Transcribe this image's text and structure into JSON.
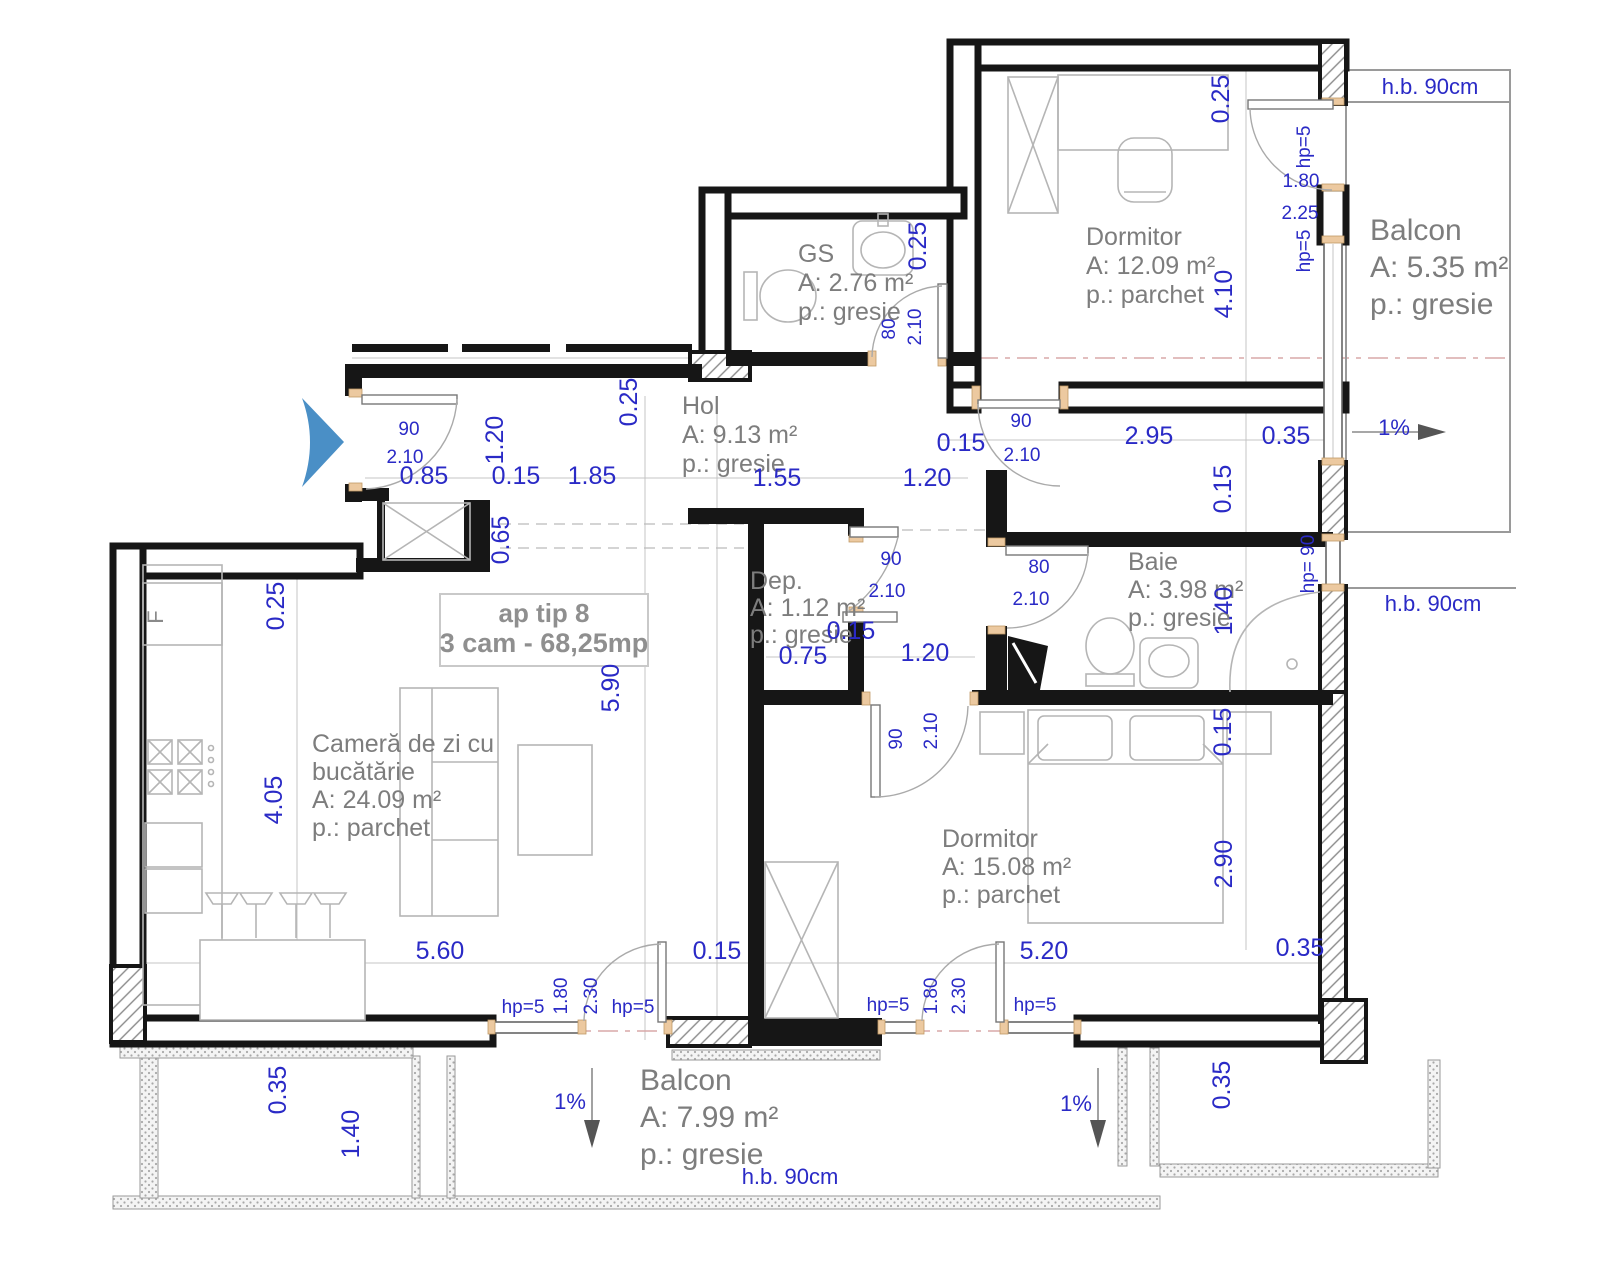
{
  "title": {
    "line1": "ap tip 8",
    "line2": "3 cam - 68,25mp"
  },
  "rooms": [
    {
      "id": "gs",
      "name": "GS",
      "area": "A: 2.76 m²",
      "floor": "p.: gresie",
      "x": 798,
      "y": 262,
      "lh": 29,
      "size": 25
    },
    {
      "id": "dormitor-1",
      "name": "Dormitor",
      "area": "A: 12.09 m²",
      "floor": "p.: parchet",
      "x": 1086,
      "y": 245,
      "lh": 29,
      "size": 25
    },
    {
      "id": "balcon-1",
      "name": "Balcon",
      "area": "A: 5.35 m²",
      "floor": "p.: gresie",
      "x": 1370,
      "y": 240,
      "lh": 37,
      "size": 30
    },
    {
      "id": "hol",
      "name": "Hol",
      "area": "A: 9.13 m²",
      "floor": "p.: gresie",
      "x": 682,
      "y": 414,
      "lh": 29,
      "size": 25
    },
    {
      "id": "dep",
      "name": "Dep.",
      "area": "A: 1.12 m²",
      "floor": "p.: gresie",
      "x": 750,
      "y": 589,
      "lh": 27,
      "size": 23
    },
    {
      "id": "baie",
      "name": "Baie",
      "area": "A: 3.98 m²",
      "floor": "p.: gresie",
      "x": 1128,
      "y": 570,
      "lh": 28,
      "size": 25
    },
    {
      "id": "camera-de-zi",
      "name": "Cameră de zi cu bucătărie",
      "area": "A: 24.09 m²",
      "floor": "p.: parchet",
      "lines": [
        "Cameră de zi cu",
        "bucătărie",
        "A: 24.09 m²",
        "p.: parchet"
      ],
      "x": 312,
      "y": 752,
      "lh": 28,
      "size": 25
    },
    {
      "id": "dormitor-2",
      "name": "Dormitor",
      "area": "A: 15.08 m²",
      "floor": "p.: parchet",
      "x": 942,
      "y": 847,
      "lh": 28,
      "size": 25
    },
    {
      "id": "balcon-2",
      "name": "Balcon",
      "area": "A: 7.99 m²",
      "floor": "p.: gresie",
      "x": 640,
      "y": 1090,
      "lh": 37,
      "size": 30
    }
  ],
  "dimensions": [
    {
      "t": "0.85",
      "x": 424,
      "y": 484
    },
    {
      "t": "0.15",
      "x": 516,
      "y": 484
    },
    {
      "t": "1.85",
      "x": 592,
      "y": 484
    },
    {
      "t": "1.55",
      "x": 777,
      "y": 486
    },
    {
      "t": "1.20",
      "x": 927,
      "y": 486
    },
    {
      "t": "1.20",
      "x": 503,
      "y": 440,
      "r": -90
    },
    {
      "t": "0.25",
      "x": 637,
      "y": 402,
      "r": -90
    },
    {
      "t": "0.65",
      "x": 509,
      "y": 540,
      "r": -90
    },
    {
      "t": "0.25",
      "x": 284,
      "y": 606,
      "r": -90
    },
    {
      "t": "4.05",
      "x": 282,
      "y": 800,
      "r": -90
    },
    {
      "t": "5.90",
      "x": 619,
      "y": 688,
      "r": -90
    },
    {
      "t": "0.25",
      "x": 926,
      "y": 246,
      "r": -90
    },
    {
      "t": "0.25",
      "x": 1229,
      "y": 99,
      "r": -90
    },
    {
      "t": "4.10",
      "x": 1232,
      "y": 294,
      "r": -90
    },
    {
      "t": "0.15",
      "x": 961,
      "y": 451
    },
    {
      "t": "2.95",
      "x": 1149,
      "y": 444
    },
    {
      "t": "0.35",
      "x": 1286,
      "y": 444
    },
    {
      "t": "0.15",
      "x": 1231,
      "y": 489,
      "r": -90
    },
    {
      "t": "1.40",
      "x": 1232,
      "y": 611,
      "r": -90
    },
    {
      "t": "0.15",
      "x": 1231,
      "y": 732,
      "r": -90
    },
    {
      "t": "2.90",
      "x": 1232,
      "y": 864,
      "r": -90
    },
    {
      "t": "0.15",
      "x": 851,
      "y": 639
    },
    {
      "t": "0.75",
      "x": 803,
      "y": 664
    },
    {
      "t": "1.20",
      "x": 925,
      "y": 661
    },
    {
      "t": "5.60",
      "x": 440,
      "y": 959
    },
    {
      "t": "0.15",
      "x": 717,
      "y": 959
    },
    {
      "t": "5.20",
      "x": 1044,
      "y": 959
    },
    {
      "t": "0.35",
      "x": 1300,
      "y": 956
    },
    {
      "t": "0.35",
      "x": 286,
      "y": 1090,
      "r": -90
    },
    {
      "t": "1.40",
      "x": 359,
      "y": 1134,
      "r": -90
    },
    {
      "t": "0.35",
      "x": 1230,
      "y": 1085,
      "r": -90
    }
  ],
  "door_labels": [
    {
      "t": "90",
      "x": 409,
      "y": 435
    },
    {
      "t": "2.10",
      "x": 405,
      "y": 463
    },
    {
      "t": "80",
      "x": 895,
      "y": 329,
      "r": -90
    },
    {
      "t": "2.10",
      "x": 921,
      "y": 327,
      "r": -90
    },
    {
      "t": "90",
      "x": 1021,
      "y": 427
    },
    {
      "t": "2.10",
      "x": 1022,
      "y": 461
    },
    {
      "t": "90",
      "x": 891,
      "y": 565
    },
    {
      "t": "2.10",
      "x": 887,
      "y": 597
    },
    {
      "t": "80",
      "x": 1039,
      "y": 573
    },
    {
      "t": "2.10",
      "x": 1031,
      "y": 605
    },
    {
      "t": "90",
      "x": 902,
      "y": 739,
      "r": -90
    },
    {
      "t": "2.10",
      "x": 937,
      "y": 731,
      "r": -90
    }
  ],
  "window_labels": [
    {
      "t": "hp=5",
      "x": 1310,
      "y": 147,
      "r": -90
    },
    {
      "t": "1.80",
      "x": 1301,
      "y": 187
    },
    {
      "t": "2.25",
      "x": 1300,
      "y": 219
    },
    {
      "t": "hp=5",
      "x": 1310,
      "y": 251,
      "r": -90
    },
    {
      "t": "hp= 90",
      "x": 1314,
      "y": 564,
      "r": -90
    },
    {
      "t": "hp=5",
      "x": 523,
      "y": 1013
    },
    {
      "t": "1.80",
      "x": 567,
      "y": 996,
      "r": -90
    },
    {
      "t": "2.30",
      "x": 597,
      "y": 996,
      "r": -90
    },
    {
      "t": "hp=5",
      "x": 633,
      "y": 1013
    },
    {
      "t": "hp=5",
      "x": 888,
      "y": 1011
    },
    {
      "t": "1.80",
      "x": 937,
      "y": 996,
      "r": -90
    },
    {
      "t": "2.30",
      "x": 965,
      "y": 996,
      "r": -90
    },
    {
      "t": "hp=5",
      "x": 1035,
      "y": 1011
    }
  ],
  "notes": [
    {
      "t": "h.b. 90cm",
      "x": 1430,
      "y": 94
    },
    {
      "t": "h.b. 90cm",
      "x": 1433,
      "y": 611
    },
    {
      "t": "h.b. 90cm",
      "x": 790,
      "y": 1184
    },
    {
      "t": "1%",
      "x": 1394,
      "y": 435
    },
    {
      "t": "1%",
      "x": 570,
      "y": 1109
    },
    {
      "t": "1%",
      "x": 1076,
      "y": 1111
    },
    {
      "t": "F",
      "x": 163,
      "y": 617,
      "r": -90,
      "c": "gray",
      "s": 20
    }
  ],
  "colors": {
    "dimension_blue": "#2a2ac6",
    "room_gray": "#7d7d7d",
    "wall_black": "#161616",
    "door_sill_tan": "#ecc9a0",
    "entrance_arrow_blue": "#4a8fc6"
  }
}
